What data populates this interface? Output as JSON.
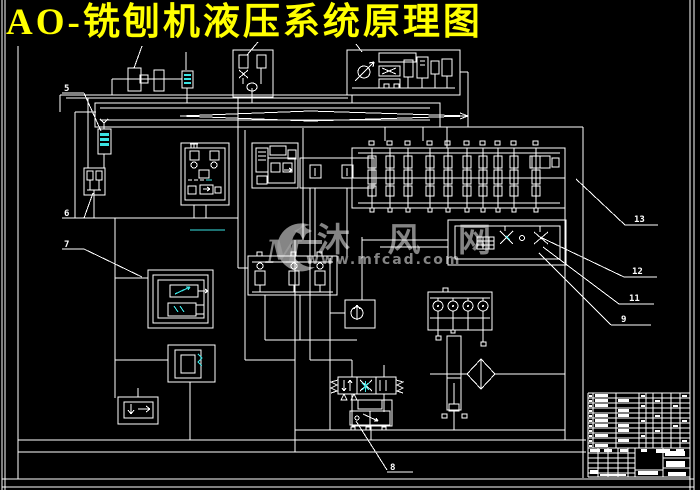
{
  "title": {
    "text": "AO-铣刨机液压系统原理图"
  },
  "watermark": {
    "logo_letter": "M",
    "name": "沐 风 网",
    "url": "www.mfcad.com"
  },
  "part_labels": [
    "5",
    "6",
    "7",
    "8",
    "9",
    "11",
    "12",
    "13"
  ],
  "colors": {
    "background": "#000000",
    "line": "#ffffff",
    "title": "#ffff00",
    "accent_cyan": "#3ae3e3",
    "watermark": "#9c9c9c"
  }
}
